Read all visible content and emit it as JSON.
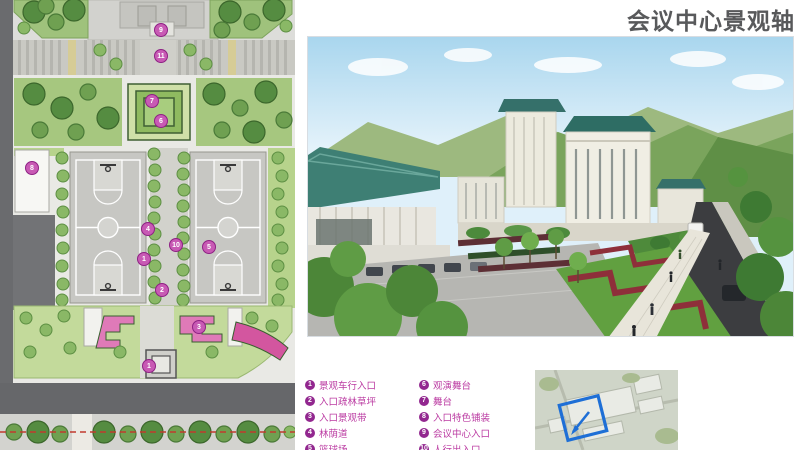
{
  "title": "会议中心景观轴",
  "colors": {
    "title_gray": "#58595b",
    "legend_text": "#bb3ba2",
    "legend_badge": "#92278f",
    "plan_marker": "#c85ab4",
    "keymap_highlight": "#1e6fd6",
    "roof_teal": "#2e6d64",
    "hedge_red": "#8e2f3a"
  },
  "legend": {
    "columns": [
      {
        "items": [
          {
            "num": "1",
            "label": "景观车行入口"
          },
          {
            "num": "2",
            "label": "入口疏林草坪"
          },
          {
            "num": "3",
            "label": "入口景观带"
          },
          {
            "num": "4",
            "label": "林荫道"
          },
          {
            "num": "5",
            "label": "篮球场"
          }
        ]
      },
      {
        "items": [
          {
            "num": "6",
            "label": "观演舞台"
          },
          {
            "num": "7",
            "label": "舞台"
          },
          {
            "num": "8",
            "label": "入口特色铺装"
          },
          {
            "num": "9",
            "label": "会议中心入口"
          },
          {
            "num": "10",
            "label": "人行出入口"
          }
        ]
      }
    ]
  },
  "plan": {
    "markers": [
      {
        "n": "9",
        "x": 161,
        "y": 30
      },
      {
        "n": "11",
        "x": 161,
        "y": 56
      },
      {
        "n": "7",
        "x": 152,
        "y": 101
      },
      {
        "n": "6",
        "x": 161,
        "y": 121
      },
      {
        "n": "8",
        "x": 32,
        "y": 168
      },
      {
        "n": "4",
        "x": 148,
        "y": 229
      },
      {
        "n": "10",
        "x": 176,
        "y": 245
      },
      {
        "n": "5",
        "x": 209,
        "y": 247
      },
      {
        "n": "1",
        "x": 144,
        "y": 259
      },
      {
        "n": "2",
        "x": 162,
        "y": 290
      },
      {
        "n": "3",
        "x": 199,
        "y": 327
      },
      {
        "n": "1",
        "x": 149,
        "y": 366
      }
    ]
  }
}
